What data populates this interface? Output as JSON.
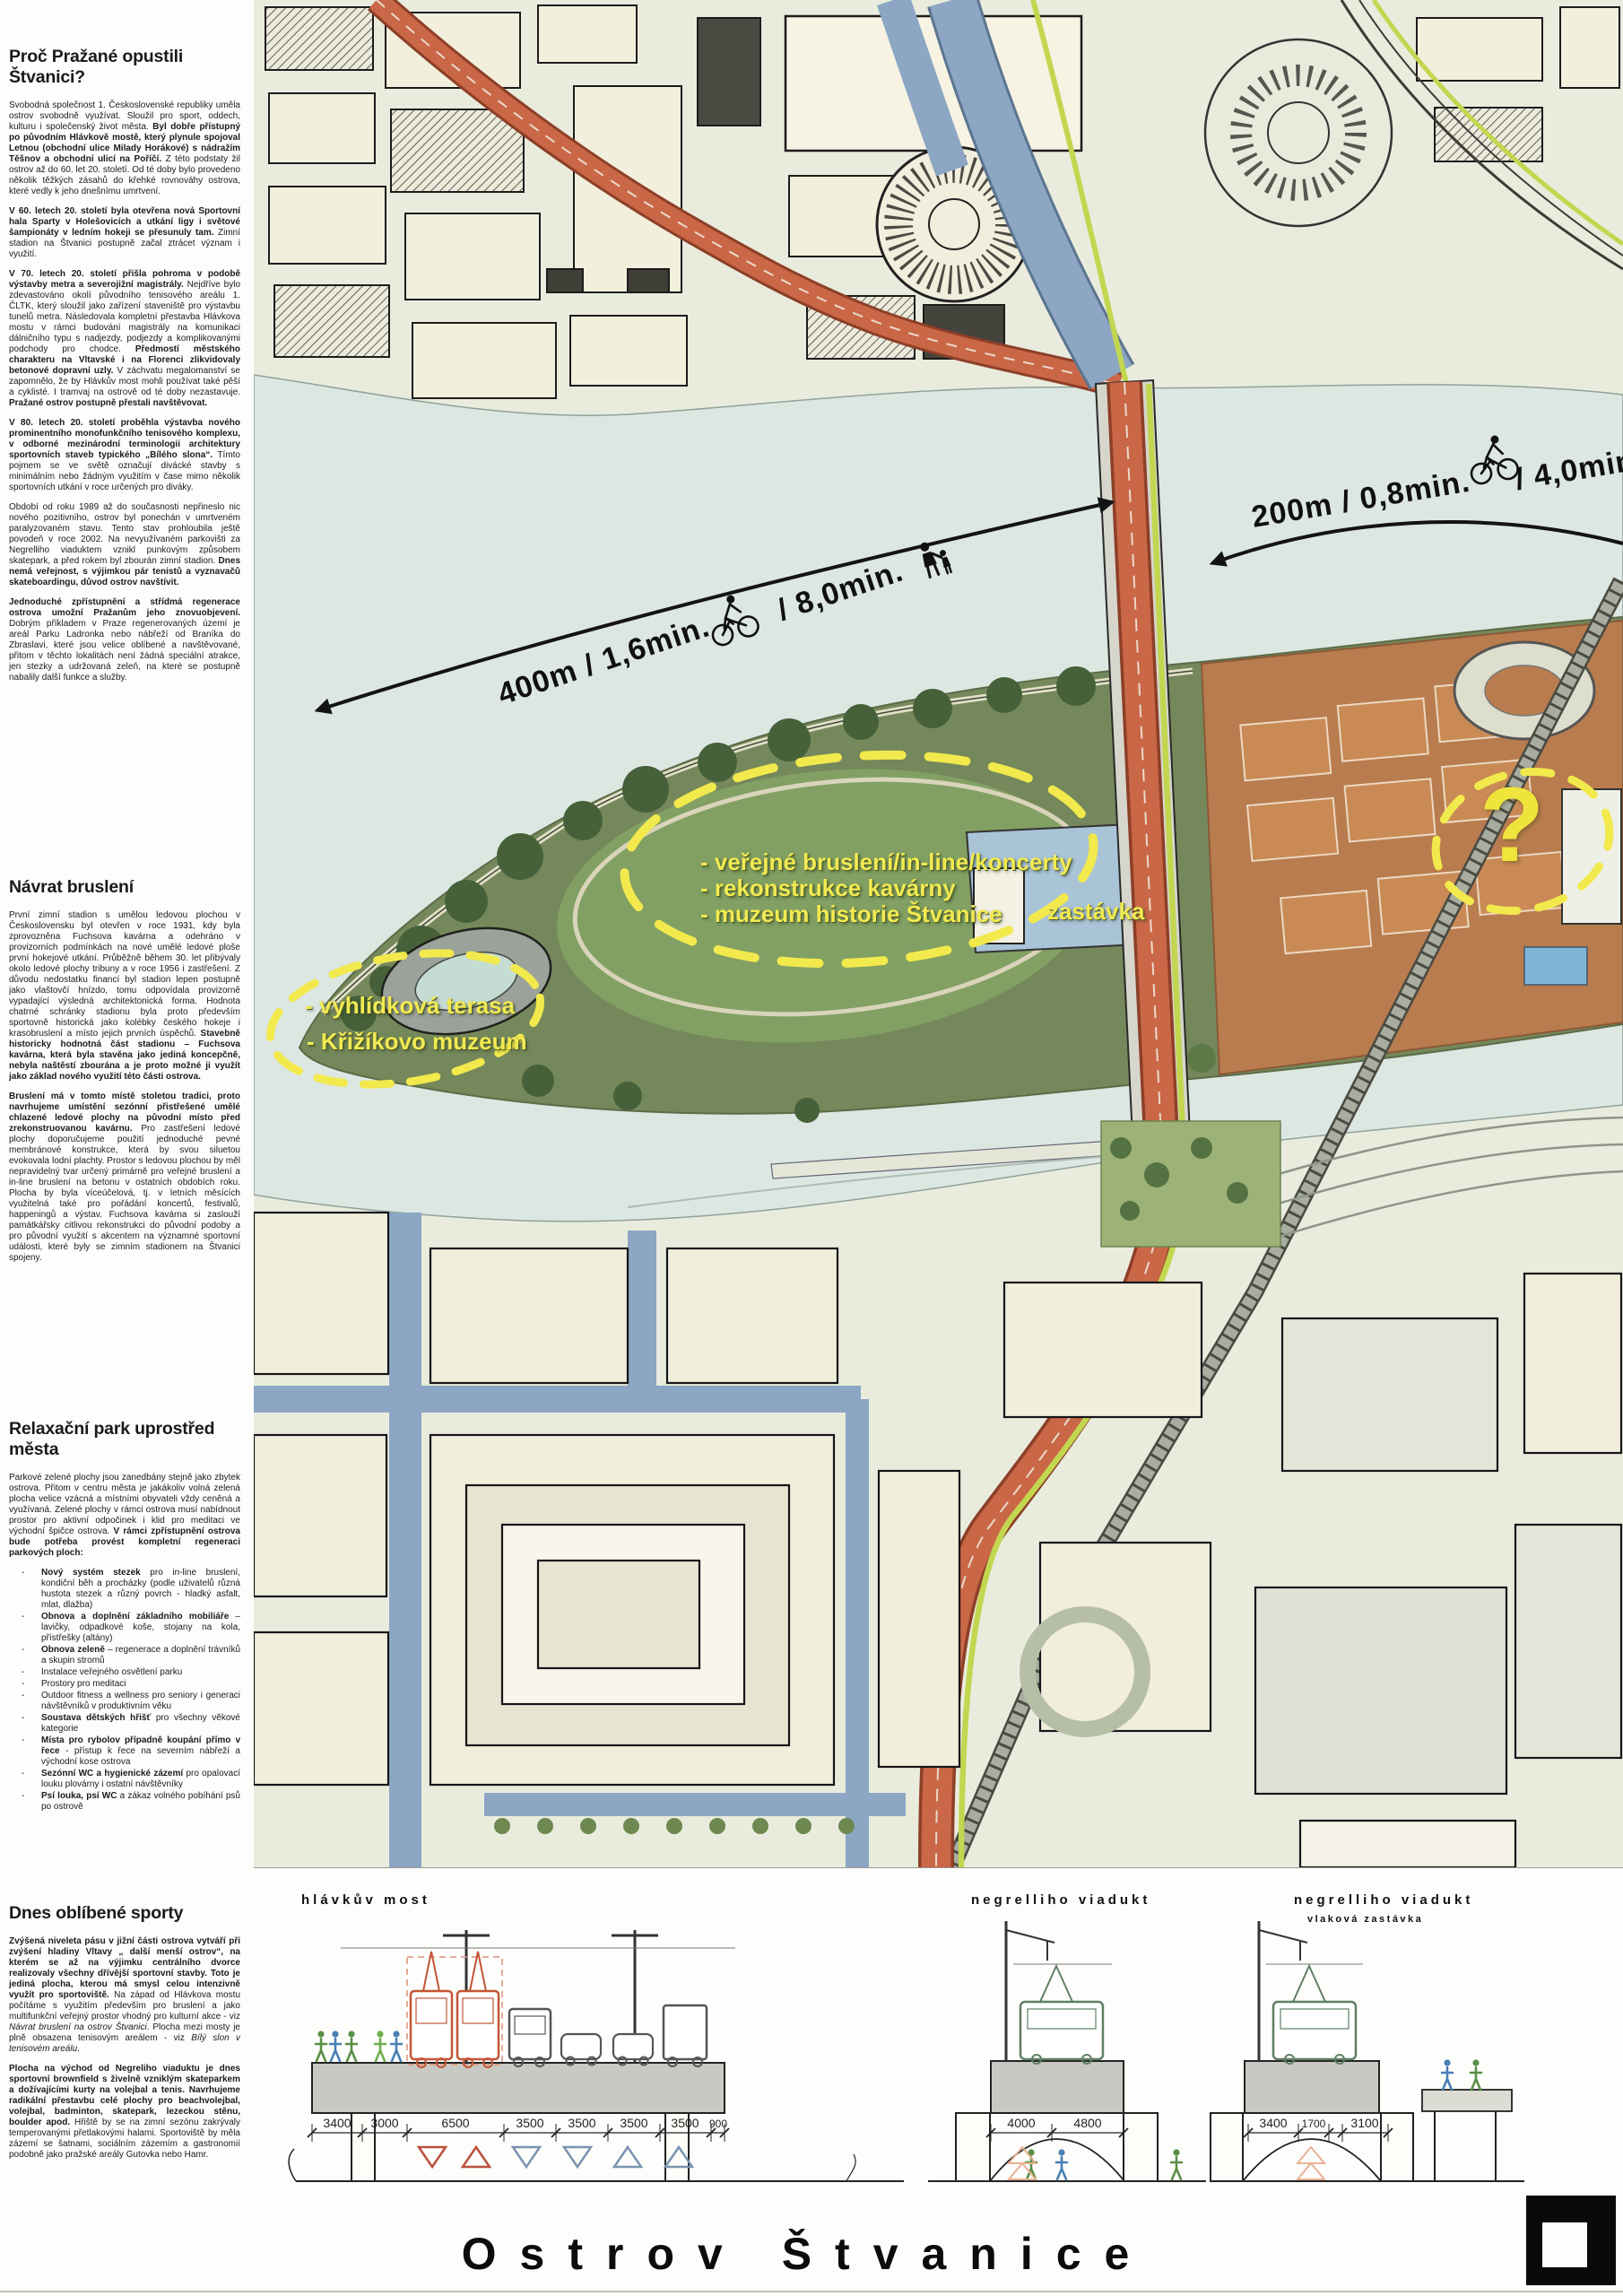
{
  "sidebar": {
    "sec1": {
      "h": "Proč Pražané opustili Štvanici?",
      "p1": [
        {
          "t": "Svobodná společnost 1. Československé republiky uměla ostrov svobodně využívat. Sloužil pro sport, oddech, kulturu i společenský život města. "
        },
        {
          "t": "Byl dobře přístupný po původním Hlávkově mostě, který plynule spojoval Letnou (obchodní ulice Milady Horákové) s nádražím Těšnov a obchodní ulicí na Poříčí.",
          "b": true
        },
        {
          "t": " Z této podstaty žil ostrov až do 60. let 20. století. Od té doby bylo provedeno několik těžkých zásahů do křehké rovnováhy ostrova, které vedly k jeho dnešnímu umrtvení."
        }
      ],
      "p2": [
        {
          "t": "V 60. letech 20. století byla otevřena nová Sportovní hala Sparty v Holešovicích a utkání ligy i světové šampionáty v ledním hokeji se přesunuly tam.",
          "b": true
        },
        {
          "t": " Zimní stadion na Štvanici postupně začal ztrácet význam i využití."
        }
      ],
      "p3": [
        {
          "t": "V 70. letech 20. století přišla pohroma v podobě výstavby metra a severojižní magistrály.",
          "b": true
        },
        {
          "t": " Nejdříve bylo zdevastováno okolí původního tenisového areálu 1. ČLTK, který sloužil jako zařízení staveniště pro výstavbu tunelů metra. Následovala kompletní přestavba Hlávkova mostu v rámci budování magistrály na komunikaci dálničního typu s nadjezdy, podjezdy a komplikovanými podchody pro chodce. "
        },
        {
          "t": "Předmostí městského charakteru na Vltavské i na Florenci zlikvidovaly betonové dopravní uzly.",
          "b": true
        },
        {
          "t": " V záchvatu megalomanství se zapomnělo, že by Hlávkův most mohli používat také pěší a cyklisté. I tramvaj na ostrově od té doby nezastavuje. "
        },
        {
          "t": "Pražané ostrov postupně přestali navštěvovat.",
          "b": true
        }
      ],
      "p4": [
        {
          "t": "V 80. letech 20. století proběhla výstavba nového prominentního monofunkčního tenisového komplexu, v odborné mezinárodní terminologii architektury sportovních staveb typického „Bílého slona“.",
          "b": true
        },
        {
          "t": " Tímto pojmem se ve světě označují divácké stavby s minimálním nebo žádným využitím v čase mimo několik sportovních utkání v roce určených pro diváky."
        }
      ],
      "p5": [
        {
          "t": "Období od roku 1989 až do současnosti nepřineslo nic nového pozitivního, ostrov byl ponechán v umrtveném paralyzovaném stavu. Tento stav prohloubila ještě povodeň v roce 2002. Na nevyužívaném parkovišti za Negrelliho viaduktem vznikl punkovým způsobem skatepark, a před rokem byl zbourán zimní stadion. "
        },
        {
          "t": "Dnes nemá veřejnost, s výjimkou pár tenistů a vyznavačů skateboardingu, důvod ostrov navštívit.",
          "b": true
        }
      ],
      "p6": [
        {
          "t": "Jednoduché zpřístupnění a střídmá regenerace ostrova umožní Pražanům jeho znovuobjevení.",
          "b": true
        },
        {
          "t": " Dobrým příkladem v Praze regenerovaných území je areál Parku Ladronka nebo nábřeží od Braníka do Zbraslavi, které jsou velice oblíbené a navštěvované, přitom v těchto lokalitách není žádná speciální atrakce, jen stezky a udržovaná zeleň, na které se postupně nabalily další funkce a služby."
        }
      ]
    },
    "sec2": {
      "h": "Návrat bruslení",
      "p1": [
        {
          "t": "První zimní stadion s umělou ledovou plochou v Československu byl otevřen v roce 1931, kdy byla zprovozněna Fuchsova kavárna a odehráno v provizorních podmínkách na nové umělé ledové ploše první hokejové utkání. Průběžně během 30. let přibývaly okolo ledové plochy tribuny a v roce 1956 i zastřešení. Z důvodu nedostatku financí byl stadion lepen postupně jako vlaštovčí hnízdo, tomu odpovídala provizorně vypadající výsledná architektonická forma. Hodnota chatrné schránky stadionu byla proto především sportovně historická jako kolébky českého hokeje i krasobruslení a místo jejich prvních úspěchů. "
        },
        {
          "t": "Stavebně historicky hodnotná část stadionu – Fuchsova kavárna, která byla stavěna jako jediná koncepčně, nebyla naštěstí zbourána a je proto možné ji využít jako základ nového využití této části ostrova.",
          "b": true
        }
      ],
      "p2": [
        {
          "t": "Bruslení má v tomto místě stoletou tradici, proto navrhujeme umístění sezónní přistřešené umělé chlazené ledové plochy na původní místo před zrekonstruovanou kavárnu.",
          "b": true
        },
        {
          "t": " Pro zastřešení ledové plochy doporučujeme použití jednoduché pevné membránové konstrukce, která by svou siluetou evokovala lodní plachty. Prostor s ledovou plochou by měl nepravidelný tvar určený primárně pro veřejné bruslení a in-line bruslení na betonu v ostatních obdobích roku. Plocha by byla víceúčelová, tj. v letních měsících využitelná také pro pořádání koncertů, festivalů, happeningů a výstav. Fuchsova kavárna si zaslouží památkářsky citlivou rekonstrukci do původní podoby a pro původní využití s akcentem na významné sportovní události, které byly se zimním stadionem na Štvanici spojeny."
        }
      ]
    },
    "sec3": {
      "h": "Relaxační park uprostřed města",
      "p1": [
        {
          "t": "Parkové zelené plochy jsou zanedbány stejně jako zbytek ostrova. Přitom v centru města je jakákoliv volná zelená plocha velice vzácná a místními obyvateli vždy ceněná a využívaná. Zelené plochy v rámci ostrova musí nabídnout prostor pro aktivní odpočinek i klid pro meditaci ve východní špičce ostrova. "
        },
        {
          "t": "V rámci zpřístupnění ostrova bude potřeba provést kompletní regeneraci parkových ploch:",
          "b": true
        }
      ],
      "items": [
        [
          {
            "t": "Nový systém stezek",
            "b": true
          },
          {
            "t": " pro in-line bruslení, kondiční běh a procházky (podle uživatelů různá hustota stezek a různý povrch - hladký asfalt, mlat, dlažba)"
          }
        ],
        [
          {
            "t": "Obnova a doplnění základního mobiliáře",
            "b": true
          },
          {
            "t": " – lavičky, odpadkové koše, stojany na kola, přístřešky (altány)"
          }
        ],
        [
          {
            "t": "Obnova zeleně",
            "b": true
          },
          {
            "t": " – regenerace a doplnění trávníků a skupin stromů"
          }
        ],
        [
          {
            "t": "Instalace veřejného osvětlení parku"
          }
        ],
        [
          {
            "t": "Prostory pro meditaci"
          }
        ],
        [
          {
            "t": "Outdoor fitness a wellness pro seniory i generaci návštěvníků v produktivním věku"
          }
        ],
        [
          {
            "t": "Soustava dětských hřišť",
            "b": true
          },
          {
            "t": " pro všechny věkové kategorie"
          }
        ],
        [
          {
            "t": "Místa pro rybolov případně koupání přímo v řece",
            "b": true
          },
          {
            "t": " - přístup k řece na severním nábřeží a východní kose ostrova"
          }
        ],
        [
          {
            "t": "Sezónní WC a hygienické zázemí",
            "b": true
          },
          {
            "t": " pro opalovací louku plovárny i ostatní návštěvníky"
          }
        ],
        [
          {
            "t": "Psí louka, psí WC",
            "b": true
          },
          {
            "t": " a zákaz volného pobíhání psů po ostrově"
          }
        ]
      ]
    },
    "sec4": {
      "h": "Dnes oblíbené sporty",
      "p1": [
        {
          "t": "Zvýšená niveleta pásu v jižní části ostrova vytváří při zvýšení hladiny Vltavy „ další menší ostrov“, na kterém se až na výjimku centrálního dvorce realizovaly všechny dřívější sportovní stavby. Toto je jediná plocha, kterou má smysl celou intenzivně využít pro sportoviště.",
          "b": true
        },
        {
          "t": " Na západ od Hlávkova mostu počítáme s využitím především pro bruslení a jako multifunkční veřejný prostor vhodný pro kulturní akce - viz "
        },
        {
          "t": "Návrat bruslení na ostrov Štvanici",
          "i": true
        },
        {
          "t": ". Plocha mezi mosty je plně obsazena tenisovým areálem  - viz "
        },
        {
          "t": "Bílý slon v tenisovém areálu",
          "i": true
        },
        {
          "t": "."
        }
      ],
      "p2": [
        {
          "t": "Plocha na východ od Negreliho viaduktu je dnes sportovní brownfield s živelně vzniklým skateparkem a dožívajícími kurty na volejbal a tenis. Navrhujeme radikální přestavbu celé plochy pro beachvolejbal, volejbal, badminton, skatepark, lezeckou stěnu, boulder apod.",
          "b": true
        },
        {
          "t": " Hřiště by se na zimní sezónu zakrývaly temperovanými přetlakovými halami. Sportoviště by měla zázemí se šatnami, sociálním zázemím a gastronomií podobně jako pražské areály Gutovka nebo Hamr."
        }
      ]
    }
  },
  "map": {
    "dist200_a": "200m / 0,8min.",
    "dist200_b": "/ 4,0min.",
    "dist400_a": "400m / 1,6min.",
    "dist400_b": "/ 8,0min.",
    "area1_line1": "- veřejné bruslení/in-line/koncerty",
    "area1_line2": "- rekonstrukce kavárny",
    "area1_line3": "- muzeum historie Štvanice",
    "stop": "zastávka",
    "area2_line1": "- vyhlídková terasa",
    "area2_line2": "- Křižíkovo muzeum",
    "question": "?",
    "colors": {
      "annotation_yellow": "#f1ea52",
      "water": "#dce7e2",
      "island_green": "#75885b",
      "magistrala_orange": "#c96746",
      "tram_lime": "#c2d650",
      "blue_road": "#8ca6c4"
    }
  },
  "cross_sections": {
    "s1": {
      "label": "hlávkův most",
      "dims": [
        "3400",
        "3000",
        "6500",
        "3500",
        "3500",
        "3500",
        "3500",
        "900"
      ]
    },
    "s2": {
      "label": "negrelliho viadukt",
      "dims": [
        "4000",
        "4800"
      ]
    },
    "s3": {
      "label": "negrelliho viadukt",
      "sublabel": "vlaková zastávka",
      "dims": [
        "3400",
        "1700",
        "3100"
      ]
    }
  },
  "footer": {
    "title": "Ostrov Štvanice"
  }
}
